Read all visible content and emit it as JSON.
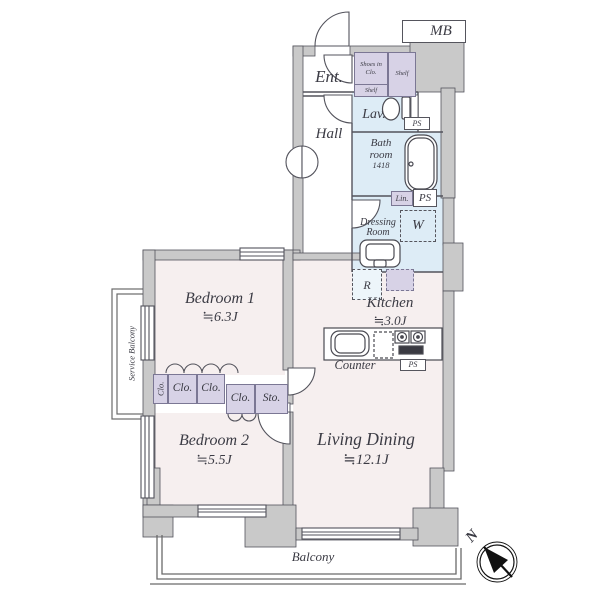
{
  "colors": {
    "wall": "#c9c9c9",
    "floor": "#f6efef",
    "wet": "#ddecf6",
    "closet": "#d7d2e6",
    "line": "#53535c",
    "text": "#3b3b44"
  },
  "rooms": {
    "entrance": {
      "label": "Ent."
    },
    "hall": {
      "label": "Hall"
    },
    "lavatory": {
      "label": "Lav."
    },
    "bathroom": {
      "label": "Bath room",
      "size": "1418"
    },
    "dressing_room": {
      "label": "Dressing Room"
    },
    "kitchen": {
      "label": "Kitchen",
      "size": "≒3.0J"
    },
    "bedroom1": {
      "label": "Bedroom 1",
      "size": "≒6.3J"
    },
    "bedroom2": {
      "label": "Bedroom 2",
      "size": "≒5.5J"
    },
    "living_dining": {
      "label": "Living Dining",
      "size": "≒12.1J"
    },
    "balcony": {
      "label": "Balcony"
    },
    "service_balcony": {
      "label": "Service Balcony"
    }
  },
  "storage": {
    "shoes_closet": {
      "label": "Shoes in Clo.",
      "shelf_bottom": "Shelf",
      "shelf_side": "Shelf"
    },
    "closet_vertical": {
      "label": "Clo."
    },
    "closet_a": {
      "label": "Clo."
    },
    "closet_b": {
      "label": "Clo."
    },
    "closet_c": {
      "label": "Clo."
    },
    "storage_box": {
      "label": "Sto."
    },
    "linen": {
      "label": "Lin."
    }
  },
  "utilities": {
    "meter_box": {
      "label": "MB"
    },
    "pipe_space_1": {
      "label": "PS"
    },
    "pipe_space_2": {
      "label": "PS"
    },
    "pipe_space_3": {
      "label": "PS"
    },
    "washer": {
      "label": "W"
    },
    "refrigerator": {
      "label": "R"
    },
    "counter": {
      "label": "Counter"
    }
  },
  "compass": {
    "north": "N"
  }
}
